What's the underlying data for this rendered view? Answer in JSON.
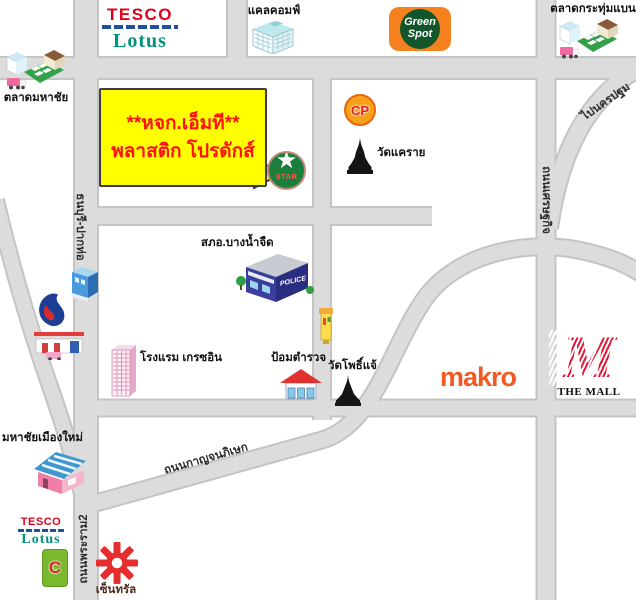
{
  "callout": {
    "line1": "**หจก.เอ็มที**",
    "line2": "พลาสติก โปรดักส์"
  },
  "icons": {
    "star": "★"
  },
  "landmarks": {
    "tesco_top": {
      "brand": "TESCO",
      "sub": "Lotus"
    },
    "calcomp": {
      "label": "แคลคอมฟ์"
    },
    "green_spot": {
      "line1": "Green",
      "line2": "Spot"
    },
    "talad_krathum_baen": {
      "label": "ตลาดกระทุ่มแบน"
    },
    "talad_mahachai": {
      "label": "ตลาดมหาชัย"
    },
    "cp": {
      "label": "CP"
    },
    "wat_khrai": {
      "label": "วัดแคราย"
    },
    "star_station": {
      "label": "STAR"
    },
    "police_station": {
      "label": "สภอ.บางน้ำจืด",
      "sign": "POLICE"
    },
    "police_box": {
      "label": "ป้อมตำรวจ"
    },
    "wat_pho_chae": {
      "label": "วัดโพธิ์แจ้"
    },
    "hotel": {
      "label": "โรงแรม เกรซอิน"
    },
    "makro": {
      "label": "makro"
    },
    "the_mall": {
      "monogram": "M",
      "label": "THE MALL"
    },
    "mahachai_muang_mai": {
      "label": "มหาชัยเมืองใหม่"
    },
    "tesco_bottom": {
      "brand": "TESCO",
      "sub": "Lotus"
    },
    "big_c": {
      "label": "C"
    },
    "central": {
      "label": "เซ็นทรัล"
    }
  },
  "road_labels": {
    "thonburi_paktho": "ธนบุรี-ปากท่อ",
    "rama2": "ถนนพระราม2",
    "setthakit": "ถนนเศรษฐกิจ",
    "to_nakhon_pathom": "ไปนครปฐม",
    "kanchanaphisek": "ถนนกาญจนภิเษก"
  }
}
